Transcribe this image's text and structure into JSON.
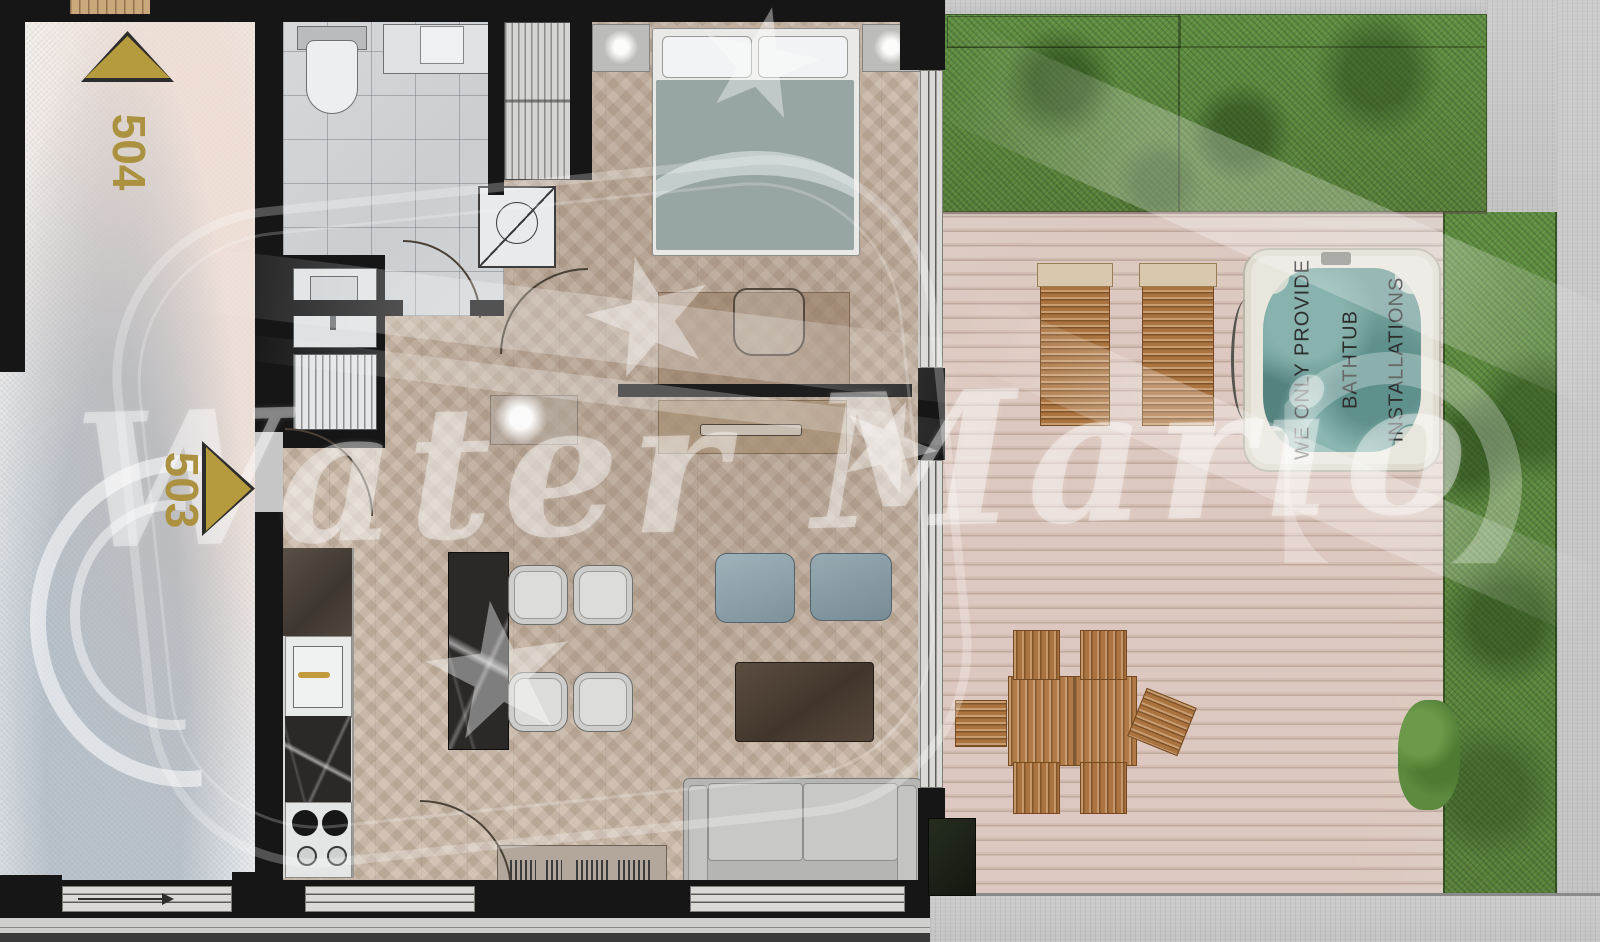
{
  "plan": {
    "title": "Apartment 503 floor plan with roof terrace",
    "units": [
      {
        "id": "504",
        "label": "504"
      },
      {
        "id": "503",
        "label": "503"
      }
    ],
    "watermark": {
      "brand_text": "Water Mario"
    },
    "hot_tub_label": {
      "line1": "WE ONLY PROVIDE",
      "line2": "BATHTUB",
      "line3": "INSTALLATIONS"
    },
    "colors": {
      "unit_label_gold": "#ab9140",
      "wall_black": "#161616",
      "parquet": "#c8b6a5",
      "bathroom_tile": "#d0d3d5",
      "terrace_deck": "#d8ccc4",
      "grass": "#5d8c3f",
      "concrete": "#c6c6c6",
      "hot_tub_water": "#74a09b",
      "outdoor_wood": "#aa733f",
      "sofa_gray": "#b4b5b2",
      "pouf_blue": "#8fa3ad"
    }
  }
}
